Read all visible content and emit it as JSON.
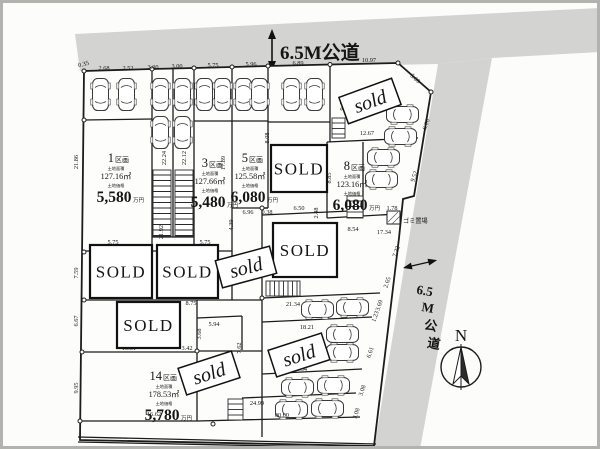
{
  "roads": {
    "top_label": "6.5M公道",
    "side_label_chars": [
      "6.5",
      "M",
      "公",
      "道"
    ],
    "garbage_label": "ゴミ置場"
  },
  "compass": {
    "north_label": "N"
  },
  "sold": {
    "upright_label": "SOLD",
    "rotated_label": "sold"
  },
  "lots": [
    {
      "number": "1",
      "suffix": "区画",
      "area_label": "土地面積",
      "area": "127.16㎡",
      "price_label": "土地価格",
      "price": "5,580",
      "price_unit": "万円"
    },
    {
      "number": "3",
      "suffix": "区画",
      "area_label": "土地面積",
      "area": "127.66㎡",
      "price_label": "土地価格",
      "price": "5,480",
      "price_unit": "万円"
    },
    {
      "number": "5",
      "suffix": "区画",
      "area_label": "土地面積",
      "area": "125.58㎡",
      "price_label": "土地価格",
      "price": "6,080",
      "price_unit": "万円"
    },
    {
      "number": "8",
      "suffix": "区画",
      "area_label": "土地面積",
      "area": "123.16㎡",
      "price_label": "土地価格",
      "price": "6,080",
      "price_unit": "万円"
    },
    {
      "number": "14",
      "suffix": "区画",
      "area_label": "土地面積",
      "area": "178.53㎡",
      "price_label": "土地価格",
      "price": "5,780",
      "price_unit": "万円"
    }
  ],
  "dimensions": [
    "0.35",
    "2.68",
    "2.52",
    "3.00",
    "3.00",
    "5.75",
    "5.96",
    "6.89",
    "10.97",
    "5.09",
    "21.86",
    "7.59",
    "6.67",
    "9.95",
    "22.24",
    "22.12",
    "21.92",
    "17.89",
    "9.41",
    "12.67",
    "8.08",
    "8.85",
    "2.48",
    "6.96",
    "0.38",
    "6.50",
    "4.39",
    "5.75",
    "5.75",
    "8.75",
    "10.51",
    "3.42",
    "5.94",
    "3.68",
    "7.62",
    "6.95",
    "16.62",
    "24.99",
    "00.00",
    "21.34",
    "18.21",
    "16.34",
    "1.78",
    "8.54",
    "17.34",
    "7.22",
    "2.65",
    "9.52",
    "6.06",
    "6.61",
    "1.23",
    "3.69",
    "3.08",
    "3.08"
  ]
}
